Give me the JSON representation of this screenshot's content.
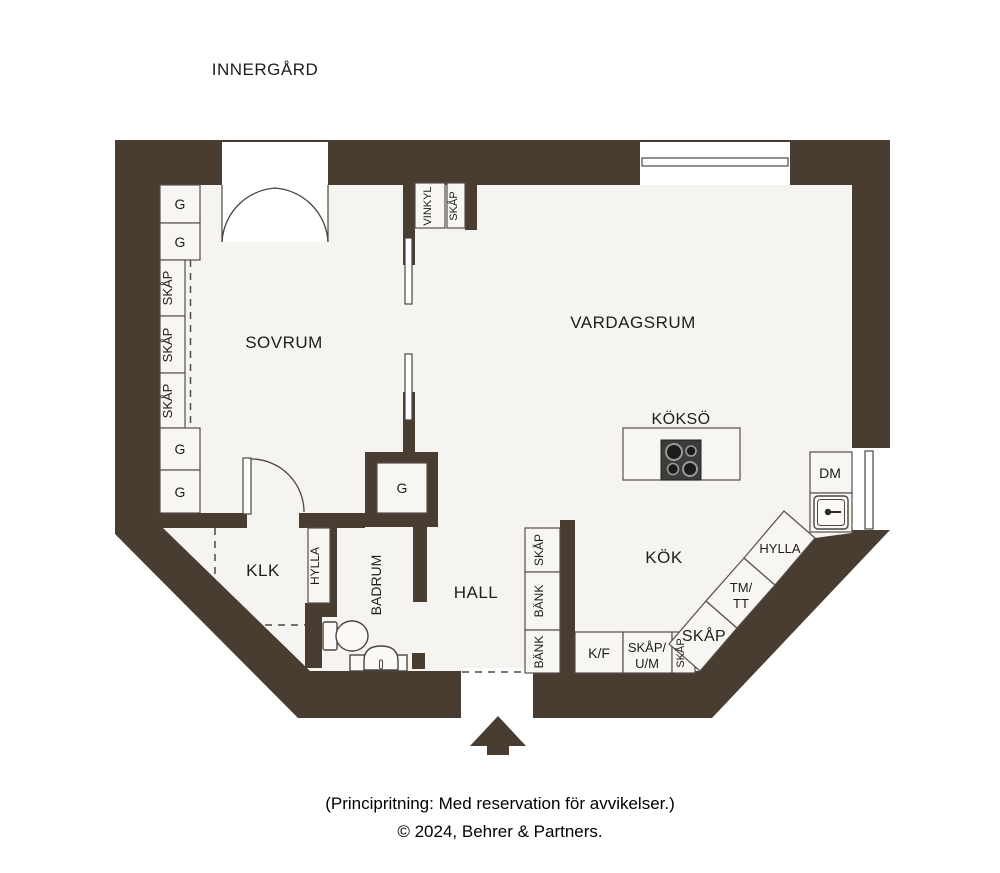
{
  "plan": {
    "site_label": "INNERGÅRD",
    "rooms": {
      "sovrum": "SOVRUM",
      "vardagsrum": "VARDAGSRUM",
      "koksoe": "KÖKSÖ",
      "kok": "KÖK",
      "hall": "HALL",
      "klk": "KLK",
      "badrum": "BADRUM"
    },
    "labels": {
      "g": "G",
      "skap": "SKÅP",
      "bank": "BÄNK",
      "vinkyl": "VINKYL",
      "hylla": "HYLLA",
      "kf": "K/F",
      "skap_um_line1": "SKÅP/",
      "skap_um_line2": "U/M",
      "tm_tt_line1": "TM/",
      "tm_tt_line2": "TT",
      "dm": "DM"
    }
  },
  "footer": {
    "line1": "(Principritning: Med reservation för avvikelser.)",
    "line2": "© 2024, Behrer & Partners."
  },
  "colors": {
    "wall": "#493c30",
    "floor": "#f6f4f0",
    "cabinet": "#f8f6f2",
    "background": "#ffffff",
    "stove": "#3e3c3a"
  }
}
